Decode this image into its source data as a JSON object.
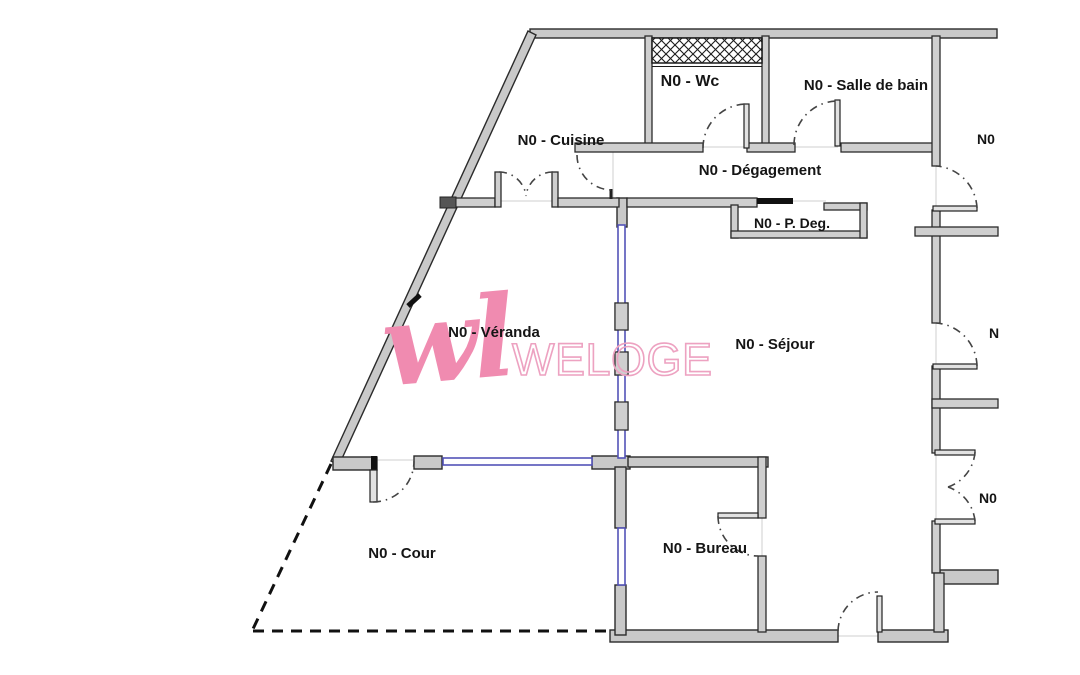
{
  "plan": {
    "title": "floor-plan-level-0",
    "rooms": {
      "wc": "N0 - Wc",
      "salle_de_bain": "N0 - Salle de bain",
      "cuisine": "N0 - Cuisine",
      "degagement": "N0 - Dégagement",
      "p_deg": "N0 - P. Deg.",
      "veranda": "N0 - Véranda",
      "sejour": "N0 - Séjour",
      "cour": "N0 - Cour",
      "bureau": "N0 - Bureau",
      "right_room_top": "N0",
      "right_room_middle": "N",
      "right_room_bottom": "N0"
    },
    "watermark": {
      "script_text": "wl",
      "brand_text": "WELOGE",
      "script_color": "#f08bb0",
      "outline_color": "#eda2c1"
    },
    "colors": {
      "wall_fill": "#c9c9c9",
      "wall_stroke": "#2b2b2b",
      "glazing_blue": "#5353b8",
      "label_black": "#151515",
      "background": "#ffffff"
    }
  }
}
